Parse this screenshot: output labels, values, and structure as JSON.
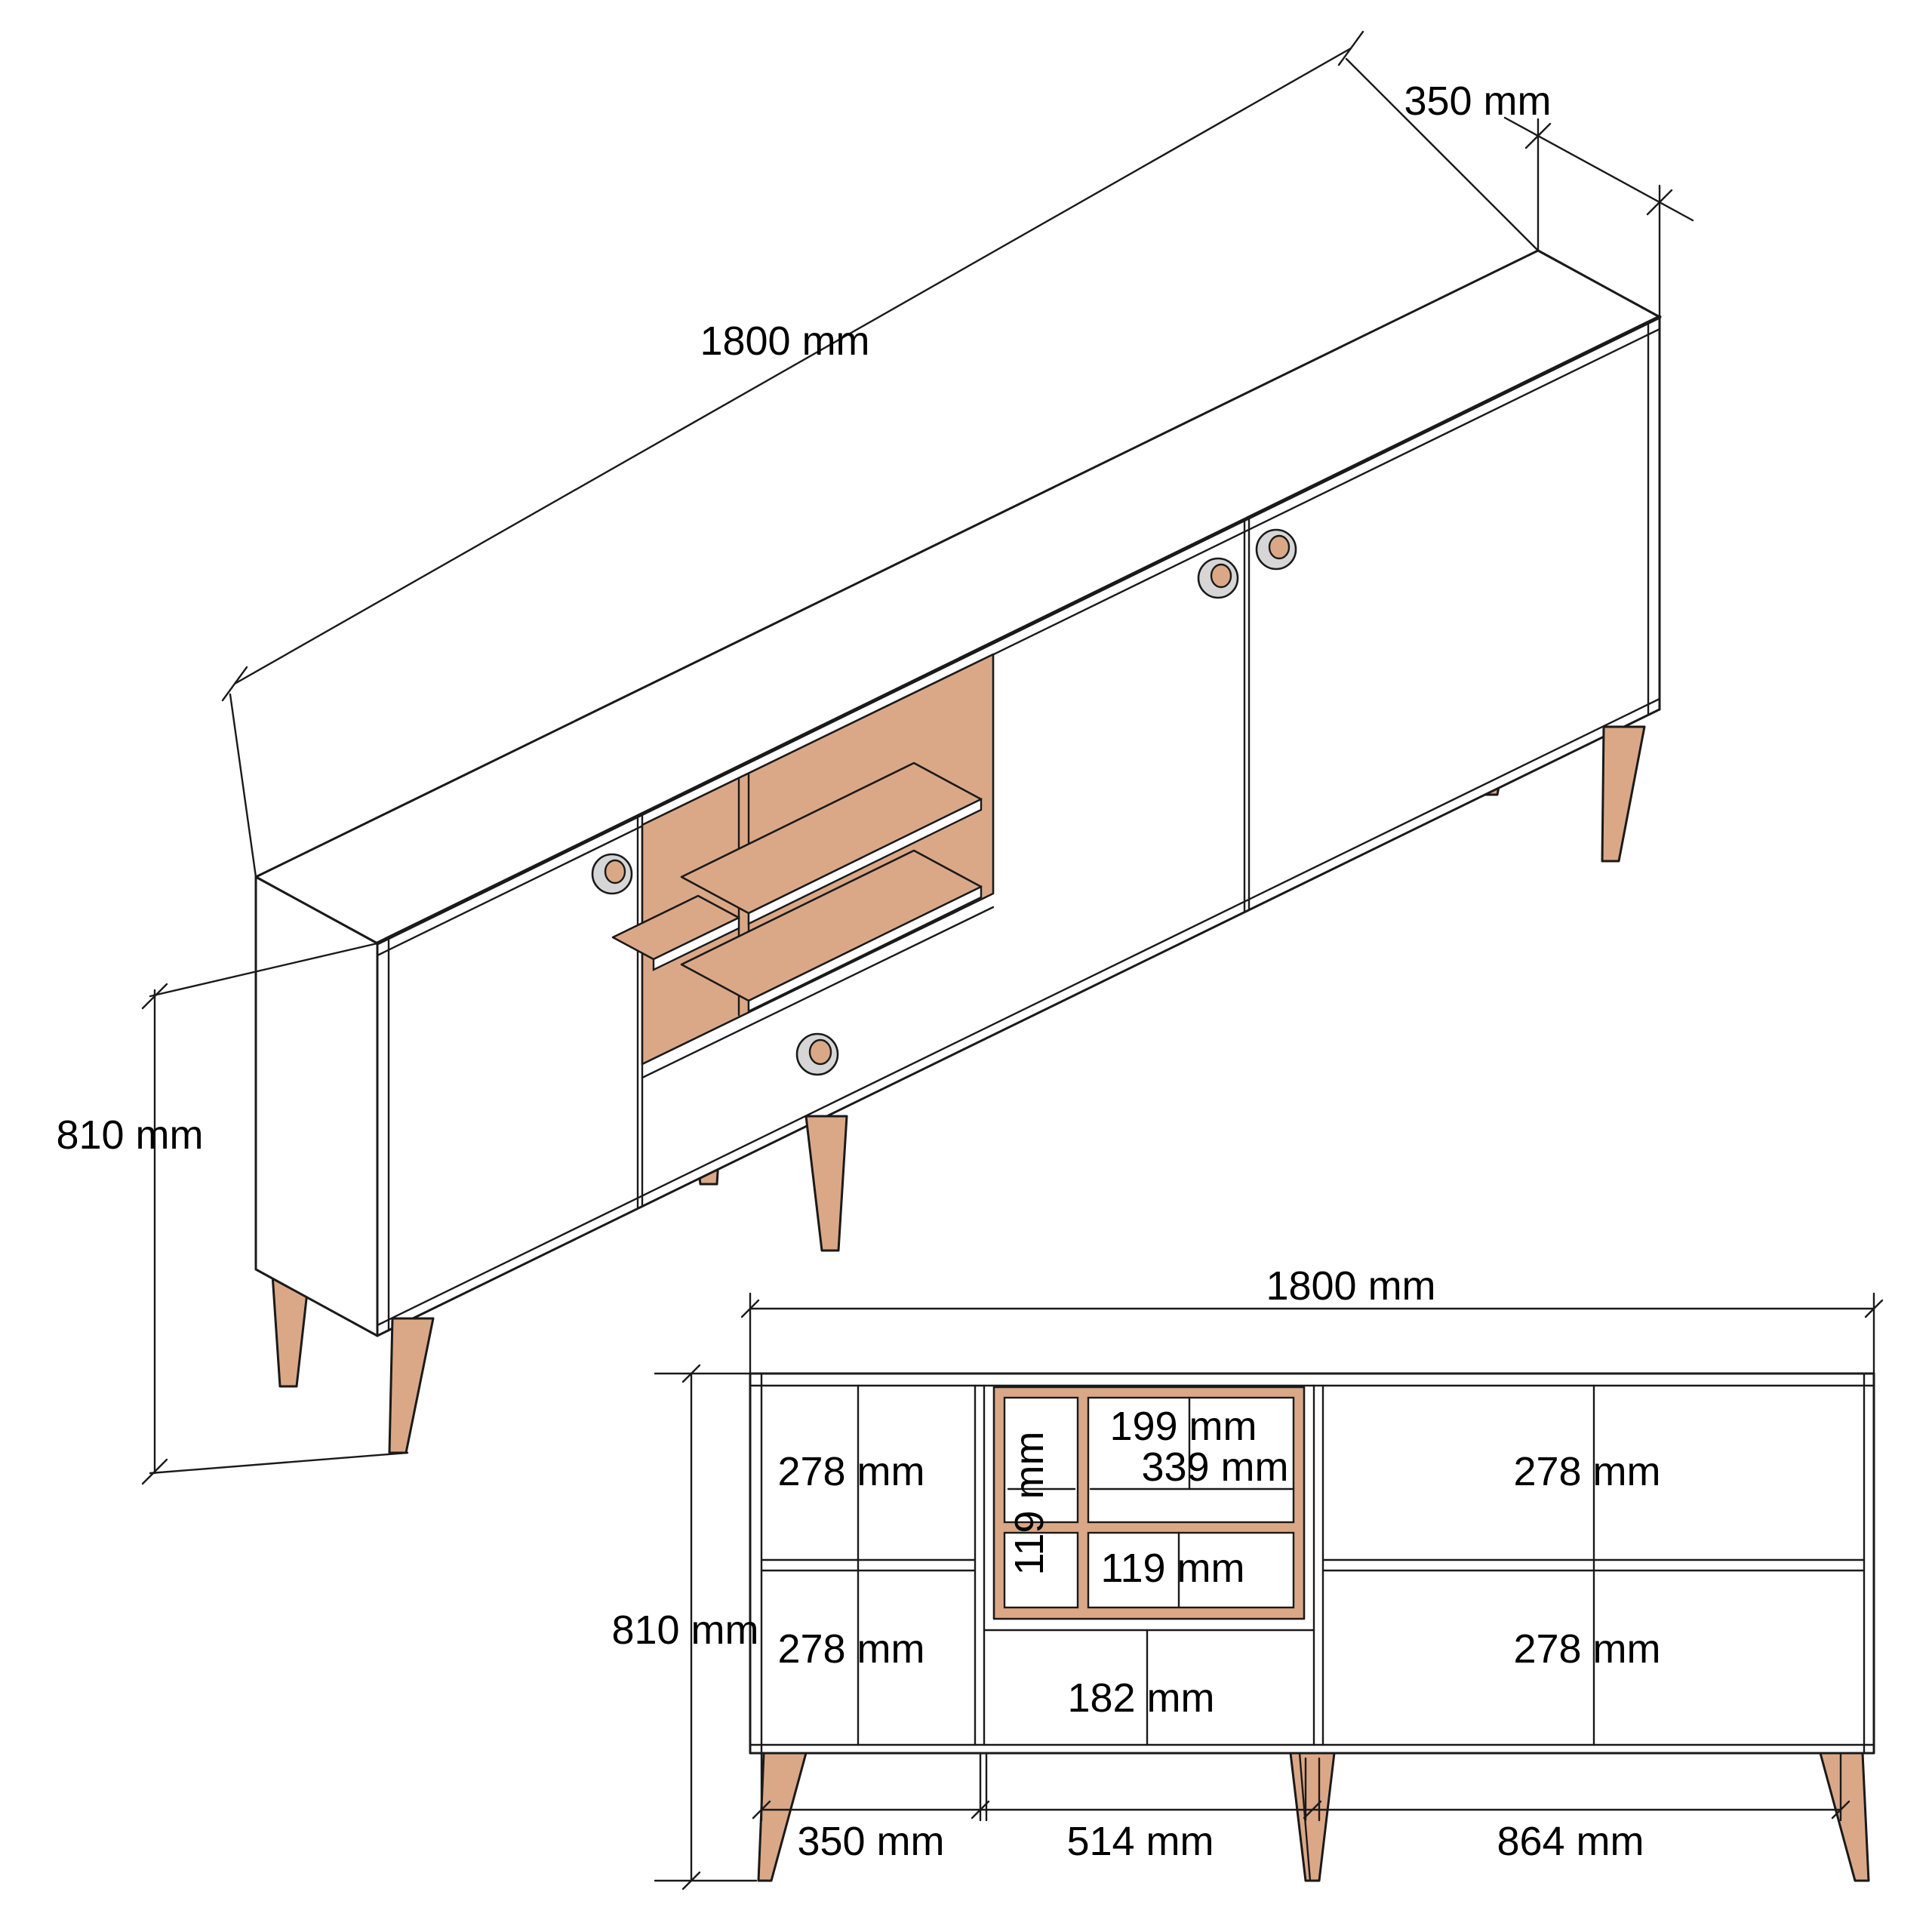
{
  "drawing_type": "furniture technical drawing (sideboard / TV stand, two projections)",
  "colors": {
    "background": "#FFFFFF",
    "line": "#1A1A1A",
    "wood": "#DBA887",
    "handle_ring": "#D6D6D6",
    "handle_center": "#DBA887"
  },
  "iso_view": {
    "width_label": "1800 mm",
    "depth_label": "350 mm",
    "height_label": "810 mm"
  },
  "front_view": {
    "width_label": "1800 mm",
    "height_label": "810 mm",
    "left_top_label": "278 mm",
    "left_bottom_label": "278 mm",
    "right_top_label": "278 mm",
    "right_bottom_label": "278 mm",
    "niche_top_height_label": "199 mm",
    "niche_width_label": "339 mm",
    "niche_column_width_label": "119 mm",
    "niche_bottom_height_label": "119 mm",
    "drawer_height_label": "182 mm",
    "bottom_left_label": "350 mm",
    "bottom_center_label": "514 mm",
    "bottom_right_label": "864 mm"
  }
}
